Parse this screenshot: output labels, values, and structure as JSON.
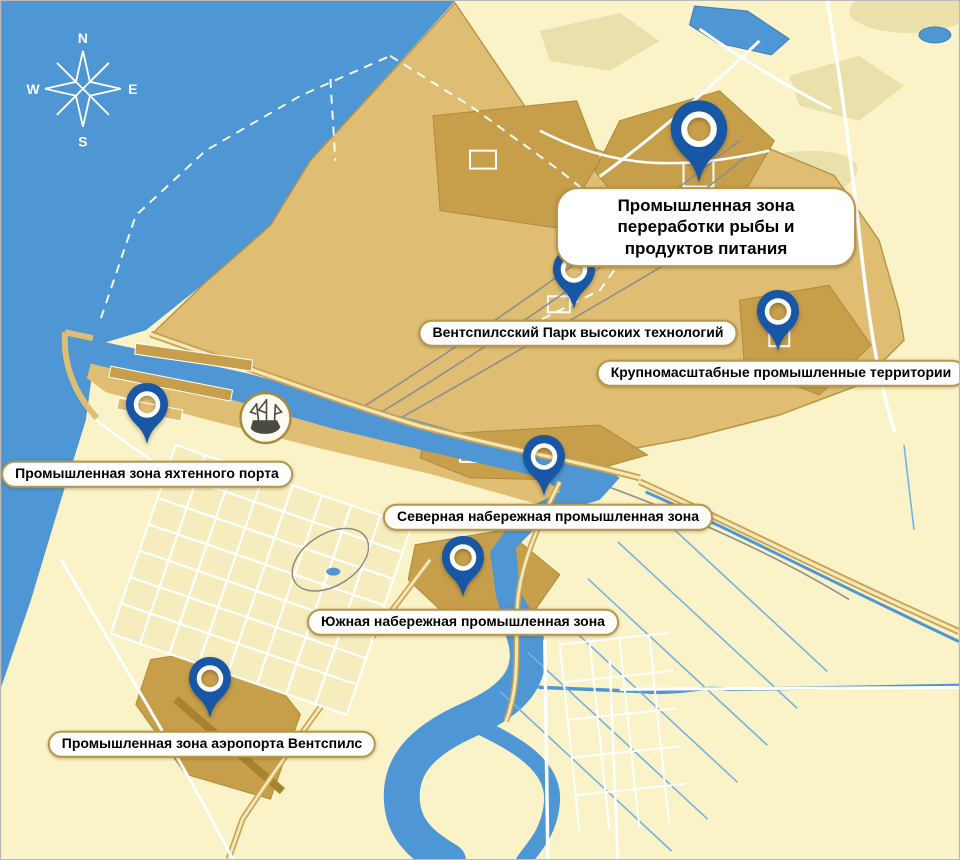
{
  "compass": {
    "n": "N",
    "e": "E",
    "s": "S",
    "w": "W"
  },
  "zones": [
    {
      "id": "fish-processing",
      "label": "Промышленная зона переработки рыбы и продуктов питания",
      "primary": true
    },
    {
      "id": "high-tech-park",
      "label": "Вентспилсский Парк высоких технологий"
    },
    {
      "id": "large-scale",
      "label": "Крупномасштабные промышленные территории"
    },
    {
      "id": "yacht-port",
      "label": "Промышленная зона яхтенного порта"
    },
    {
      "id": "north-embankment",
      "label": "Северная набережная промышленная зона"
    },
    {
      "id": "south-embankment",
      "label": "Южная набережная промышленная зона"
    },
    {
      "id": "airport",
      "label": "Промышленная зона аэропорта Вентспилс"
    }
  ],
  "colors": {
    "sea": "#4E96D4",
    "land": "#FAF3C8",
    "port_gold": "#DFBE74",
    "zone_dark": "#C79F4B",
    "pin_blue": "#1757A6",
    "label_border": "#B8964B",
    "ditch_blue": "#77B0E2"
  }
}
